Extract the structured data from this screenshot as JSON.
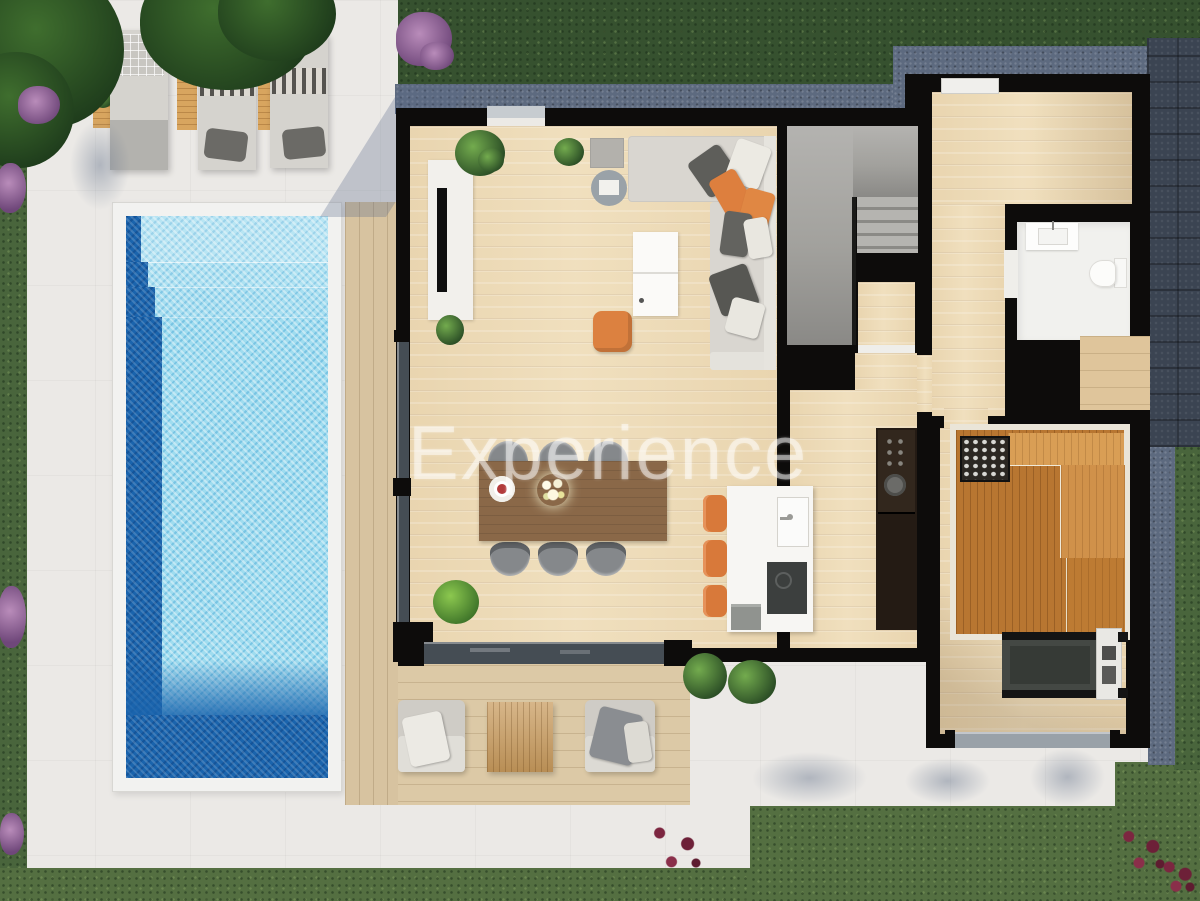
{
  "watermark": {
    "text": "Experience"
  },
  "palette": {
    "grass_top": "#36512f",
    "grass": "#546f41",
    "patio": "#ebe9e6",
    "gravel": "#5d6a7f",
    "paving": "#3b4452",
    "wall": "#0d0c0b",
    "wood_floor": "#eedcb9",
    "wood_deck": "#dcc9a6",
    "pool_water": "#9fdcef",
    "pool_deep": "#1a64ad",
    "pool_coping": "#f2f2f0",
    "sauna_wood": "#b87631",
    "accent_orange": "#dd7f3e",
    "sofa_gray": "#d9d6d0",
    "furniture_white": "#f7f6f3",
    "stairs_gray": "#a6a5a2"
  }
}
